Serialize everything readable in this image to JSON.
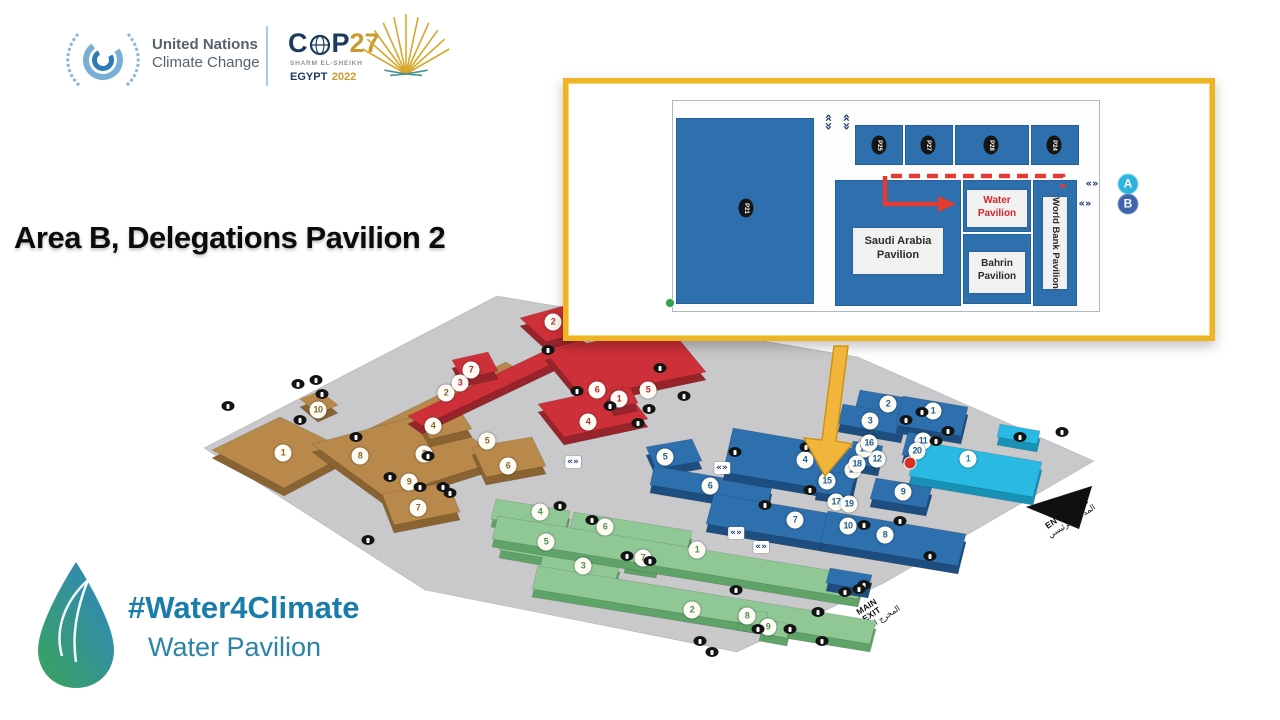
{
  "header": {
    "un_line1": "United Nations",
    "un_line2": "Climate Change",
    "cop": {
      "c": "C",
      "p": "P",
      "num": "27",
      "venue": "SHARM EL-SHEIKH",
      "egypt": "EGYPT",
      "year": "2022"
    }
  },
  "slide_title": "Area B, Delegations Pavilion 2",
  "inset": {
    "saudi_l1": "Saudi Arabia",
    "saudi_l2": "Pavilion",
    "water_l1": "Water",
    "water_l2": "Pavilion",
    "bahrain_l1": "Bahrin",
    "bahrain_l2": "Pavilion",
    "worldbank": "World Bank Pavilion",
    "marker_a": "A",
    "marker_b": "B",
    "chevron": "«»",
    "codes": [
      {
        "code": "P25",
        "x": 879,
        "y": 145
      },
      {
        "code": "P27",
        "x": 928,
        "y": 145
      },
      {
        "code": "P28",
        "x": 991,
        "y": 145
      },
      {
        "code": "P24",
        "x": 1054,
        "y": 145
      }
    ],
    "big_code": {
      "code": "P21",
      "x": 746,
      "y": 208
    }
  },
  "map": {
    "entrance_l1": "MAIN",
    "entrance_l2": "ENTRANCE",
    "entrance_ar": "المدخل الرئيسي",
    "exit_l1": "MAIN",
    "exit_l2": "EXIT",
    "exit_ar": "المخرج الرئيسي",
    "chevron": "«»",
    "zones": {
      "tan": {
        "text_color": "#8a6434",
        "badges": [
          [
            1,
            283,
            453
          ],
          [
            2,
            446,
            393
          ],
          [
            3,
            424,
            454
          ],
          [
            4,
            433,
            426
          ],
          [
            5,
            487,
            441
          ],
          [
            6,
            508,
            466
          ],
          [
            7,
            418,
            508
          ],
          [
            8,
            360,
            456
          ],
          [
            9,
            409,
            482
          ],
          [
            10,
            318,
            410
          ]
        ]
      },
      "red": {
        "text_color": "#c1272d",
        "badges": [
          [
            1,
            619,
            399
          ],
          [
            2,
            553,
            322
          ],
          [
            3,
            460,
            383
          ],
          [
            4,
            588,
            422
          ],
          [
            5,
            648,
            390
          ],
          [
            6,
            597,
            390
          ],
          [
            7,
            471,
            370
          ]
        ]
      },
      "green": {
        "text_color": "#4e8f55",
        "badges": [
          [
            1,
            697,
            550
          ],
          [
            2,
            692,
            610
          ],
          [
            3,
            583,
            566
          ],
          [
            4,
            540,
            512
          ],
          [
            5,
            546,
            542
          ],
          [
            6,
            605,
            527
          ],
          [
            7,
            643,
            558
          ],
          [
            8,
            747,
            616
          ],
          [
            9,
            768,
            627
          ]
        ]
      },
      "blue": {
        "text_color": "#1f5c9e",
        "badges": [
          [
            1,
            933,
            411
          ],
          [
            2,
            888,
            404
          ],
          [
            3,
            870,
            421
          ],
          [
            4,
            805,
            460
          ],
          [
            5,
            665,
            457
          ],
          [
            6,
            710,
            486
          ],
          [
            7,
            795,
            520
          ],
          [
            8,
            885,
            535
          ],
          [
            9,
            903,
            492
          ],
          [
            10,
            848,
            526
          ],
          [
            11,
            923,
            441
          ],
          [
            12,
            877,
            459
          ],
          [
            13,
            864,
            449
          ],
          [
            14,
            853,
            470
          ],
          [
            15,
            827,
            481
          ],
          [
            16,
            869,
            443
          ],
          [
            17,
            836,
            502
          ],
          [
            18,
            857,
            464
          ],
          [
            19,
            849,
            504
          ],
          [
            20,
            917,
            451
          ]
        ]
      },
      "cyan": {
        "text_color": "#0f93c0",
        "badges": [
          [
            1,
            968,
            459
          ]
        ]
      }
    },
    "icons": [
      [
        298,
        384
      ],
      [
        316,
        380
      ],
      [
        322,
        394
      ],
      [
        356,
        437
      ],
      [
        300,
        420
      ],
      [
        228,
        406
      ],
      [
        368,
        540
      ],
      [
        390,
        477
      ],
      [
        420,
        487
      ],
      [
        443,
        487
      ],
      [
        428,
        456
      ],
      [
        450,
        493
      ],
      [
        548,
        350
      ],
      [
        577,
        391
      ],
      [
        610,
        406
      ],
      [
        638,
        423
      ],
      [
        649,
        409
      ],
      [
        660,
        368
      ],
      [
        684,
        396
      ],
      [
        735,
        452
      ],
      [
        765,
        505
      ],
      [
        810,
        490
      ],
      [
        864,
        525
      ],
      [
        900,
        521
      ],
      [
        930,
        556
      ],
      [
        864,
        585
      ],
      [
        906,
        420
      ],
      [
        922,
        412
      ],
      [
        948,
        431
      ],
      [
        936,
        441
      ],
      [
        806,
        447
      ],
      [
        1020,
        437
      ],
      [
        1062,
        432
      ],
      [
        845,
        592
      ],
      [
        859,
        589
      ],
      [
        560,
        506
      ],
      [
        592,
        520
      ],
      [
        627,
        556
      ],
      [
        650,
        561
      ],
      [
        736,
        590
      ],
      [
        758,
        629
      ],
      [
        790,
        629
      ],
      [
        818,
        612
      ],
      [
        822,
        641
      ],
      [
        700,
        641
      ],
      [
        712,
        652
      ]
    ],
    "chevrons": [
      [
        573,
        462
      ],
      [
        722,
        468
      ],
      [
        736,
        533
      ],
      [
        761,
        547
      ]
    ],
    "red_marker": [
      910,
      463
    ]
  },
  "footer": {
    "hashtag": "#Water4Climate",
    "subtitle": "Water Pavilion"
  }
}
